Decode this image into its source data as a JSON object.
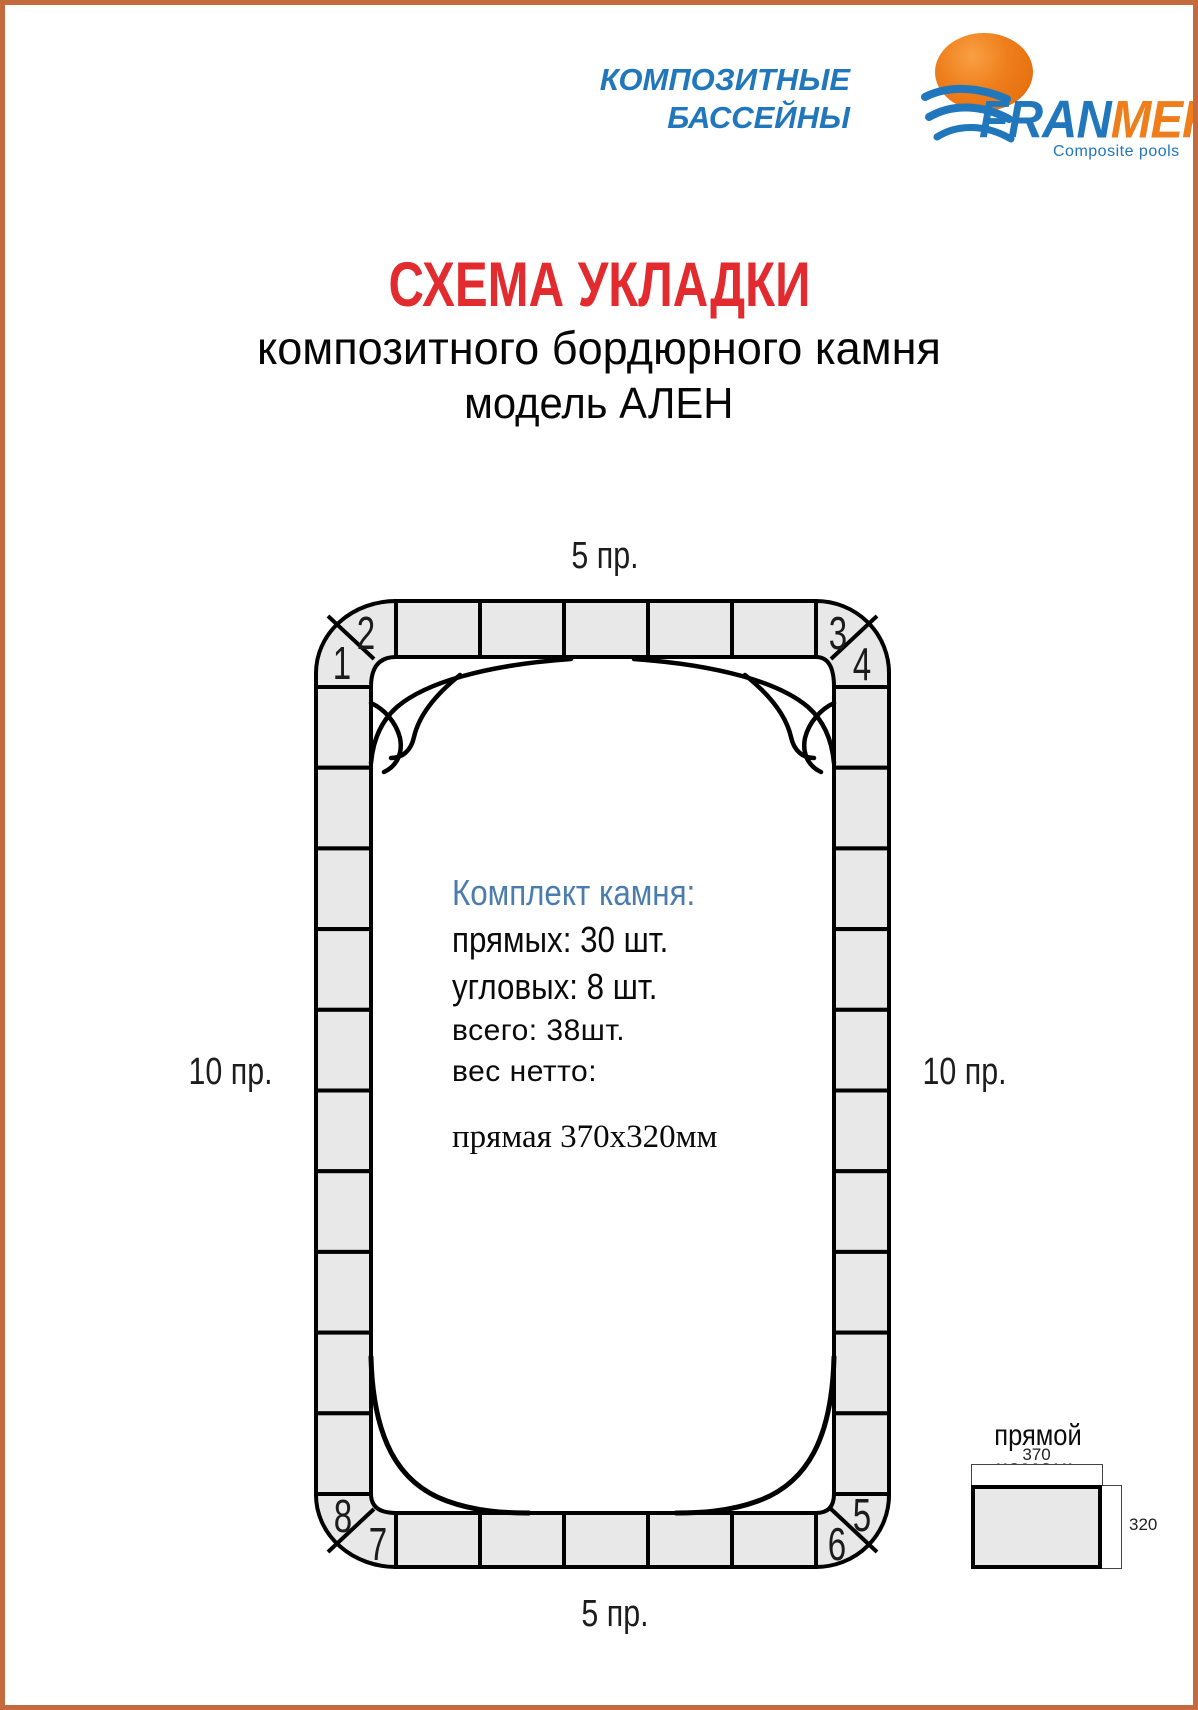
{
  "page": {
    "border_color": "#c5693e",
    "background": "#ffffff"
  },
  "header": {
    "tagline_line1": "КОМПОЗИТНЫЕ",
    "tagline_line2": "БАССЕЙНЫ",
    "brand": {
      "name_part1": "FRAN",
      "name_part2": "MER",
      "registered": "®",
      "subtitle": "Composite pools",
      "blue": "#2077bb",
      "orange": "#ee7d1b"
    }
  },
  "title": {
    "line1": "СХЕМА УКЛАДКИ",
    "line2": "композитного бордюрного камня",
    "line3": "модель АЛЕН",
    "accent_color": "#e12b2e"
  },
  "diagram": {
    "labels": {
      "top": "5 пр.",
      "bottom": "5 пр.",
      "left": "10 пр.",
      "right": "10 пр."
    },
    "corner_numbers": [
      "1",
      "2",
      "3",
      "4",
      "5",
      "6",
      "7",
      "8"
    ],
    "counts": {
      "top": 5,
      "bottom": 5,
      "left": 10,
      "right": 10,
      "corners": 8
    },
    "tile_fill": "#e8e8e8",
    "line_color": "#000000",
    "info": {
      "heading": "Комплект камня:",
      "heading_color": "#4a7dae",
      "line_straight": "прямых: 30 шт.",
      "line_corner": "угловых: 8 шт.",
      "line_total": "всего: 38шт.",
      "line_weight": "вес нетто:",
      "note": "прямая 370х320мм"
    }
  },
  "legend": {
    "title": "прямой камень",
    "width_label": "370",
    "height_label": "320"
  }
}
